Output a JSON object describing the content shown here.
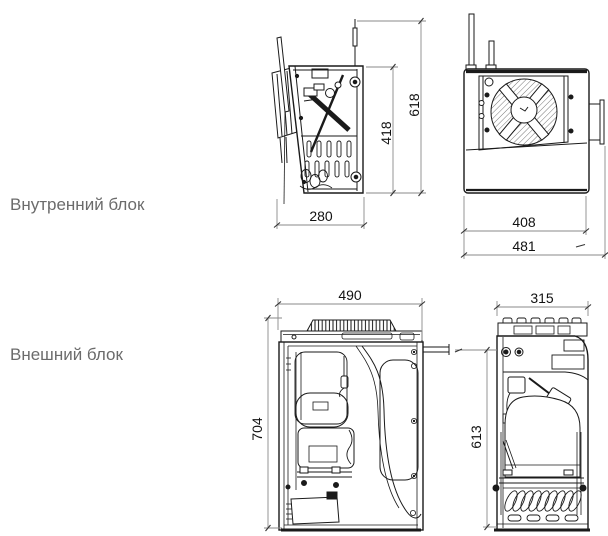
{
  "labels": {
    "internal_unit": "Внутренний блок",
    "external_unit": "Внешний блок"
  },
  "dimensions": {
    "internal_side": {
      "width": "280",
      "body_height": "418",
      "total_height": "618"
    },
    "internal_front": {
      "body_width": "408",
      "total_width": "481"
    },
    "external_front": {
      "width": "490",
      "height": "704"
    },
    "external_side": {
      "depth": "315",
      "height": "613"
    }
  },
  "colors": {
    "background": "#ffffff",
    "line": "#1a1a1a",
    "label_text": "#6b6b6b",
    "dimension_text": "#111111",
    "dimension_line": "#8a8a8a"
  }
}
